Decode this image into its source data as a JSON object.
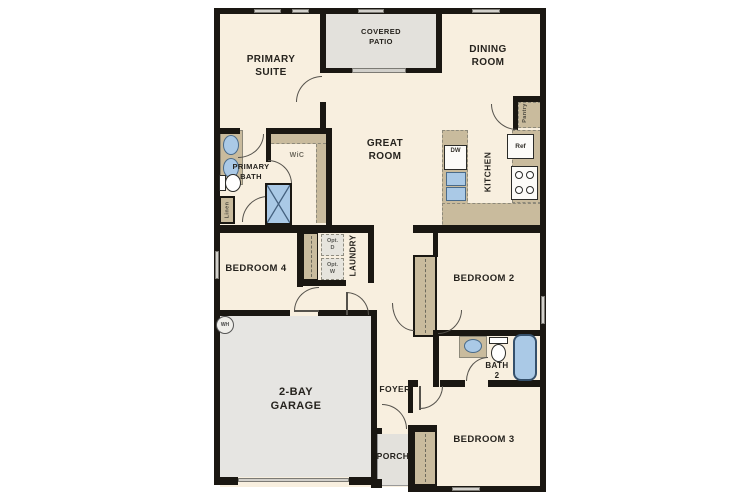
{
  "plan": {
    "title": "single-story house floor plan",
    "labels": {
      "primary_suite": "PRIMARY\nSUITE",
      "covered_patio": "COVERED\nPATIO",
      "dining_room": "DINING\nROOM",
      "great_room": "GREAT\nROOM",
      "kitchen": "KITCHEN",
      "pantry": "Pantry",
      "primary_bath": "PRIMARY\nBATH",
      "wic": "WiC",
      "linen": "Linen",
      "bedroom4": "BEDROOM 4",
      "laundry": "LAUNDRY",
      "opt_d": "Opt.\nD",
      "opt_w": "Opt.\nW",
      "bedroom2": "BEDROOM 2",
      "bath2": "BATH\n2",
      "garage": "2-BAY\nGARAGE",
      "foyer": "FOYER",
      "porch": "PORCH",
      "bedroom3": "BEDROOM 3",
      "dw": "DW",
      "ref": "Ref",
      "wh": "WH"
    },
    "colors": {
      "wall": "#1a1712",
      "floor": "#f8efdf",
      "counter_tan": "#c9bb9d",
      "patio_gray": "#e3e1dc",
      "fixture_blue": "#aac9e6",
      "fixture_blue_border": "#4a6b8a"
    }
  }
}
